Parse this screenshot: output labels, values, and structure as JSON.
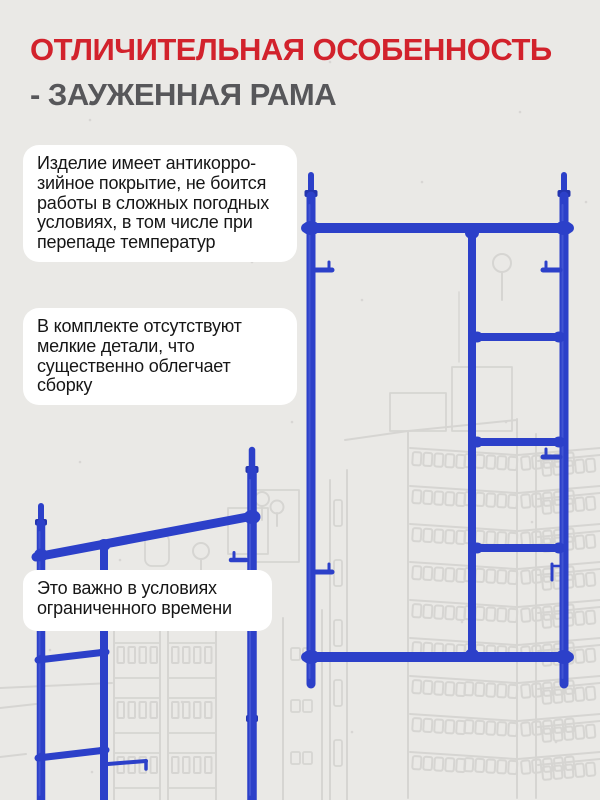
{
  "colors": {
    "page-bg": "#eae9e6",
    "card-bg": "#ffffff",
    "body-text": "#161616",
    "title-red": "#d2222c",
    "title-gray": "#57575a",
    "frame-blue": "#2c40c9",
    "frame-blue-dark": "#2334ae",
    "frame-blue-light": "#5b6ce0",
    "sketch-gray": "#d6d5d2",
    "speckle": "#c8c7c4"
  },
  "header": {
    "title": "ОТЛИЧИТЕЛЬНАЯ ОСОБЕННОСТЬ",
    "subtitle": "- ЗАУЖЕННАЯ РАМА"
  },
  "feature_cards": [
    {
      "id": "anticorrosion-coating",
      "text": "Изделие имеет антикорро-\nзийное покрытие, не боится\nработы в сложных погодных\nусловиях, в том числе при\nперепаде температур"
    },
    {
      "id": "no-small-parts",
      "text": "В комплекте отсутствуют\nмелкие детали, что\nсущественно облегчает\nсборку"
    },
    {
      "id": "limited-time",
      "text": "Это важно в условиях\nограниченного времени"
    }
  ],
  "illustrations": {
    "right_frame": "narrow-scaffold-frame-front-view",
    "left_frame": "narrow-scaffold-frame-angled-view",
    "background": "city-buildings-outline-sketch"
  }
}
